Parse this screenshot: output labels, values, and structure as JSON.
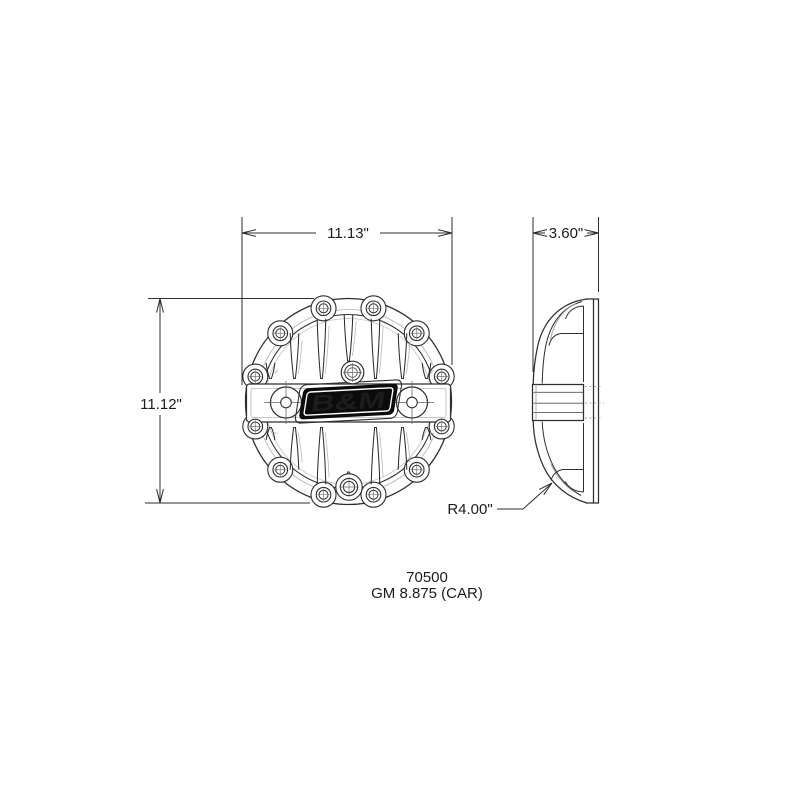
{
  "labels": {
    "width_dimension": "11.13\"",
    "depth_dimension": "3.60\"",
    "height_dimension": "11.12\"",
    "corner_radius": "R4.00\"",
    "part_number": "70500",
    "application": "GM 8.875 (CAR)"
  },
  "logo": {
    "text": "B&M",
    "background_color": "#0b0b0b",
    "foreground_color": "#ffffff"
  },
  "colors": {
    "page_background": "#ffffff",
    "primary_line": "#2e2e2e",
    "secondary_line": "#999999",
    "hidden_line": "#a6a6a6"
  }
}
